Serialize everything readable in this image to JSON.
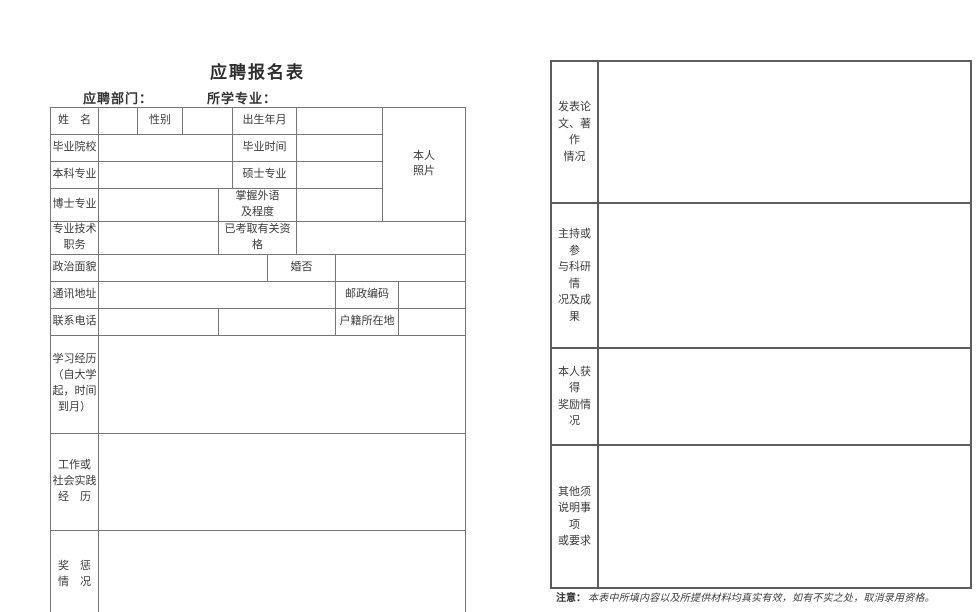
{
  "title": "应聘报名表",
  "header": {
    "department_label": "应聘部门：",
    "major_label": "所学专业："
  },
  "left_table": {
    "name": "姓　名",
    "gender": "性别",
    "birth_date": "出生年月",
    "photo": "本人\n照片",
    "graduate_school": "毕业院校",
    "graduate_time": "毕业时间",
    "bachelor_major": "本科专业",
    "master_major": "硕士专业",
    "doctor_major": "博士专业",
    "foreign_language": "掌握外语\n及程度",
    "professional_title": "专业技术\n职务",
    "qualifications": "已考取有关资格",
    "political_status": "政治面貌",
    "marital_status": "婚否",
    "mailing_address": "通讯地址",
    "postal_code": "邮政编码",
    "contact_phone": "联系电话",
    "household_location": "户籍所在地",
    "education_history": "学习经历\n（自大学\n起，时间\n到月）",
    "work_experience": "工作或\n社会实践\n经　历",
    "rewards_punishments": "奖　惩\n情　况"
  },
  "right_table": {
    "rows": [
      {
        "label": "发表论\n文、著作\n情况"
      },
      {
        "label": "主持或参\n与科研情\n况及成果"
      },
      {
        "label": "本人获得\n奖励情况"
      },
      {
        "label": "其他须\n说明事项\n或要求"
      }
    ]
  },
  "note": {
    "label": "注意：",
    "text": "本表中所填内容以及所提供材料均真实有效，如有不实之处，取消录用资格。"
  }
}
